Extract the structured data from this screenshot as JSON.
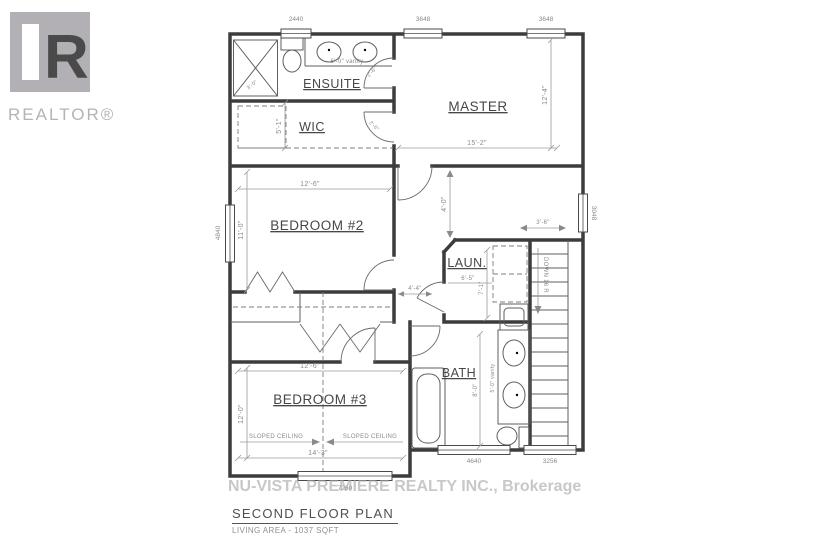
{
  "logo": {
    "letter": "R",
    "label": "REALTOR®"
  },
  "colors": {
    "line": "#3c3c3c",
    "dim_text": "#8a8a8a",
    "logo_gray": "#b2afb5",
    "watermark": "#a8a8a8"
  },
  "plan": {
    "rooms": {
      "ensuite": {
        "label": "ENSUITE",
        "vanity": "6'-0\" vanity",
        "shower": "3'-0\"",
        "door": "2'-6\""
      },
      "wic": {
        "label": "WIC",
        "depth": "5'-1\"",
        "door": "2'-6\""
      },
      "master": {
        "label": "MASTER",
        "width": "15'-2\"",
        "depth": "12'-4\""
      },
      "bedroom2": {
        "label": "BEDROOM #2",
        "width": "12'-6\"",
        "depth": "11'-0\""
      },
      "laundry": {
        "label": "LAUN.",
        "width": "6'-5\"",
        "depth": "7'-1\""
      },
      "bath": {
        "label": "BATH",
        "vanity": "5'-0\" vanity",
        "depth": "8'-0\""
      },
      "bedroom3": {
        "label": "BEDROOM #3",
        "width_top": "12'-6\"",
        "depth": "12'-0\"",
        "width_bottom": "14'-3\"",
        "sloped_left": "SLOPED CEILING",
        "sloped_right": "SLOPED CEILING"
      }
    },
    "hall": {
      "width": "4'-4\"",
      "master_side": "4'-0\"",
      "stair_width": "3'-6\""
    },
    "stairs": {
      "label": "DOWN 16 R"
    },
    "windows": {
      "ensuite_top": "2440",
      "master_left": "3648",
      "master_right": "3648",
      "bedroom2_left": "4840",
      "stairs_right": "3048",
      "bath_bottom": "4640",
      "stairs_bottom": "3256",
      "bedroom3_bottom": "7260"
    }
  },
  "watermark": "NU-VISTA PREMIERE REALTY INC., Brokerage",
  "titleblock": {
    "title": "SECOND FLOOR PLAN",
    "subtitle": "LIVING AREA - 1037 SQFT"
  }
}
